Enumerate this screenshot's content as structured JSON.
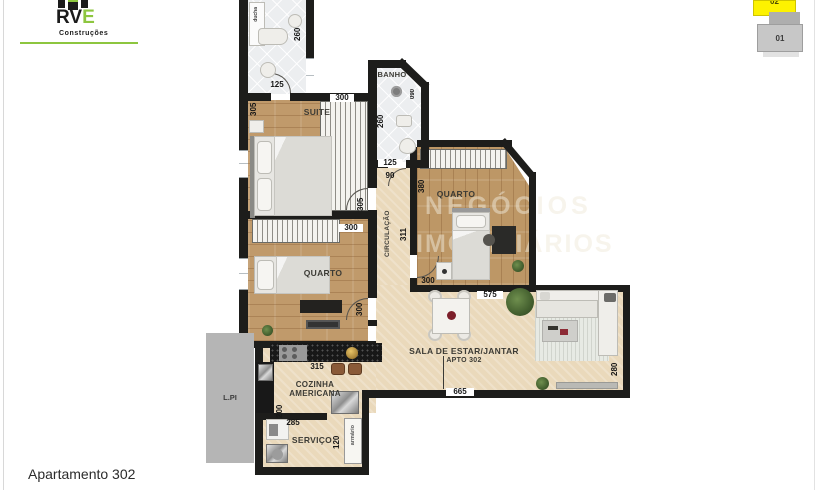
{
  "window": {
    "footer_caption": "Apartamento 302"
  },
  "logo": {
    "brand_black": "RV",
    "brand_green": "E",
    "subtitle": "Construções"
  },
  "floor_key": {
    "unit_top": "02",
    "unit_bottom": "01"
  },
  "watermark": {
    "part1": "GX",
    "part2": "NEGÓCIOS",
    "part3": "IMOBILIÁRIOS"
  },
  "rooms": {
    "suite": "SUITE",
    "banho": "BANHO",
    "quarto_left": "QUARTO",
    "quarto_right": "QUARTO",
    "circulacao": "CIRCULAÇÃO",
    "sala_title": "SALA DE ESTAR/JANTAR",
    "sala_subtitle": "APTO 302",
    "cozinha_line1": "COZINHA",
    "cozinha_line2": "AMERICANA",
    "servico": "SERVIÇO",
    "armario": "armário",
    "lpi": "L.PI",
    "ducha": "ducha"
  },
  "dims": {
    "bath_top_width": "125",
    "bath_top_depth": "260",
    "suite_width": "300",
    "suite_depth": "305",
    "banho_depth": "260",
    "banho_width": "125",
    "hall_width": "90",
    "banho_shower": "090",
    "circ_top": "305",
    "circ_length": "311",
    "quarto_left_width": "300",
    "quarto_left_depth": "300",
    "quarto_right_depth": "380",
    "quarto_right_width": "300",
    "sala_top_width": "575",
    "sala_bottom_width": "665",
    "sala_right_depth": "280",
    "cozinha_counter": "315",
    "cozinha_depth": "200",
    "servico_width": "285",
    "servico_depth": "120"
  },
  "colors": {
    "brand_green": "#8dc63f",
    "highlight_yellow": "#fdf200",
    "wall": "#1d1d1b",
    "wood": "#c09a6b",
    "floor_beige": "#ead9bb"
  }
}
